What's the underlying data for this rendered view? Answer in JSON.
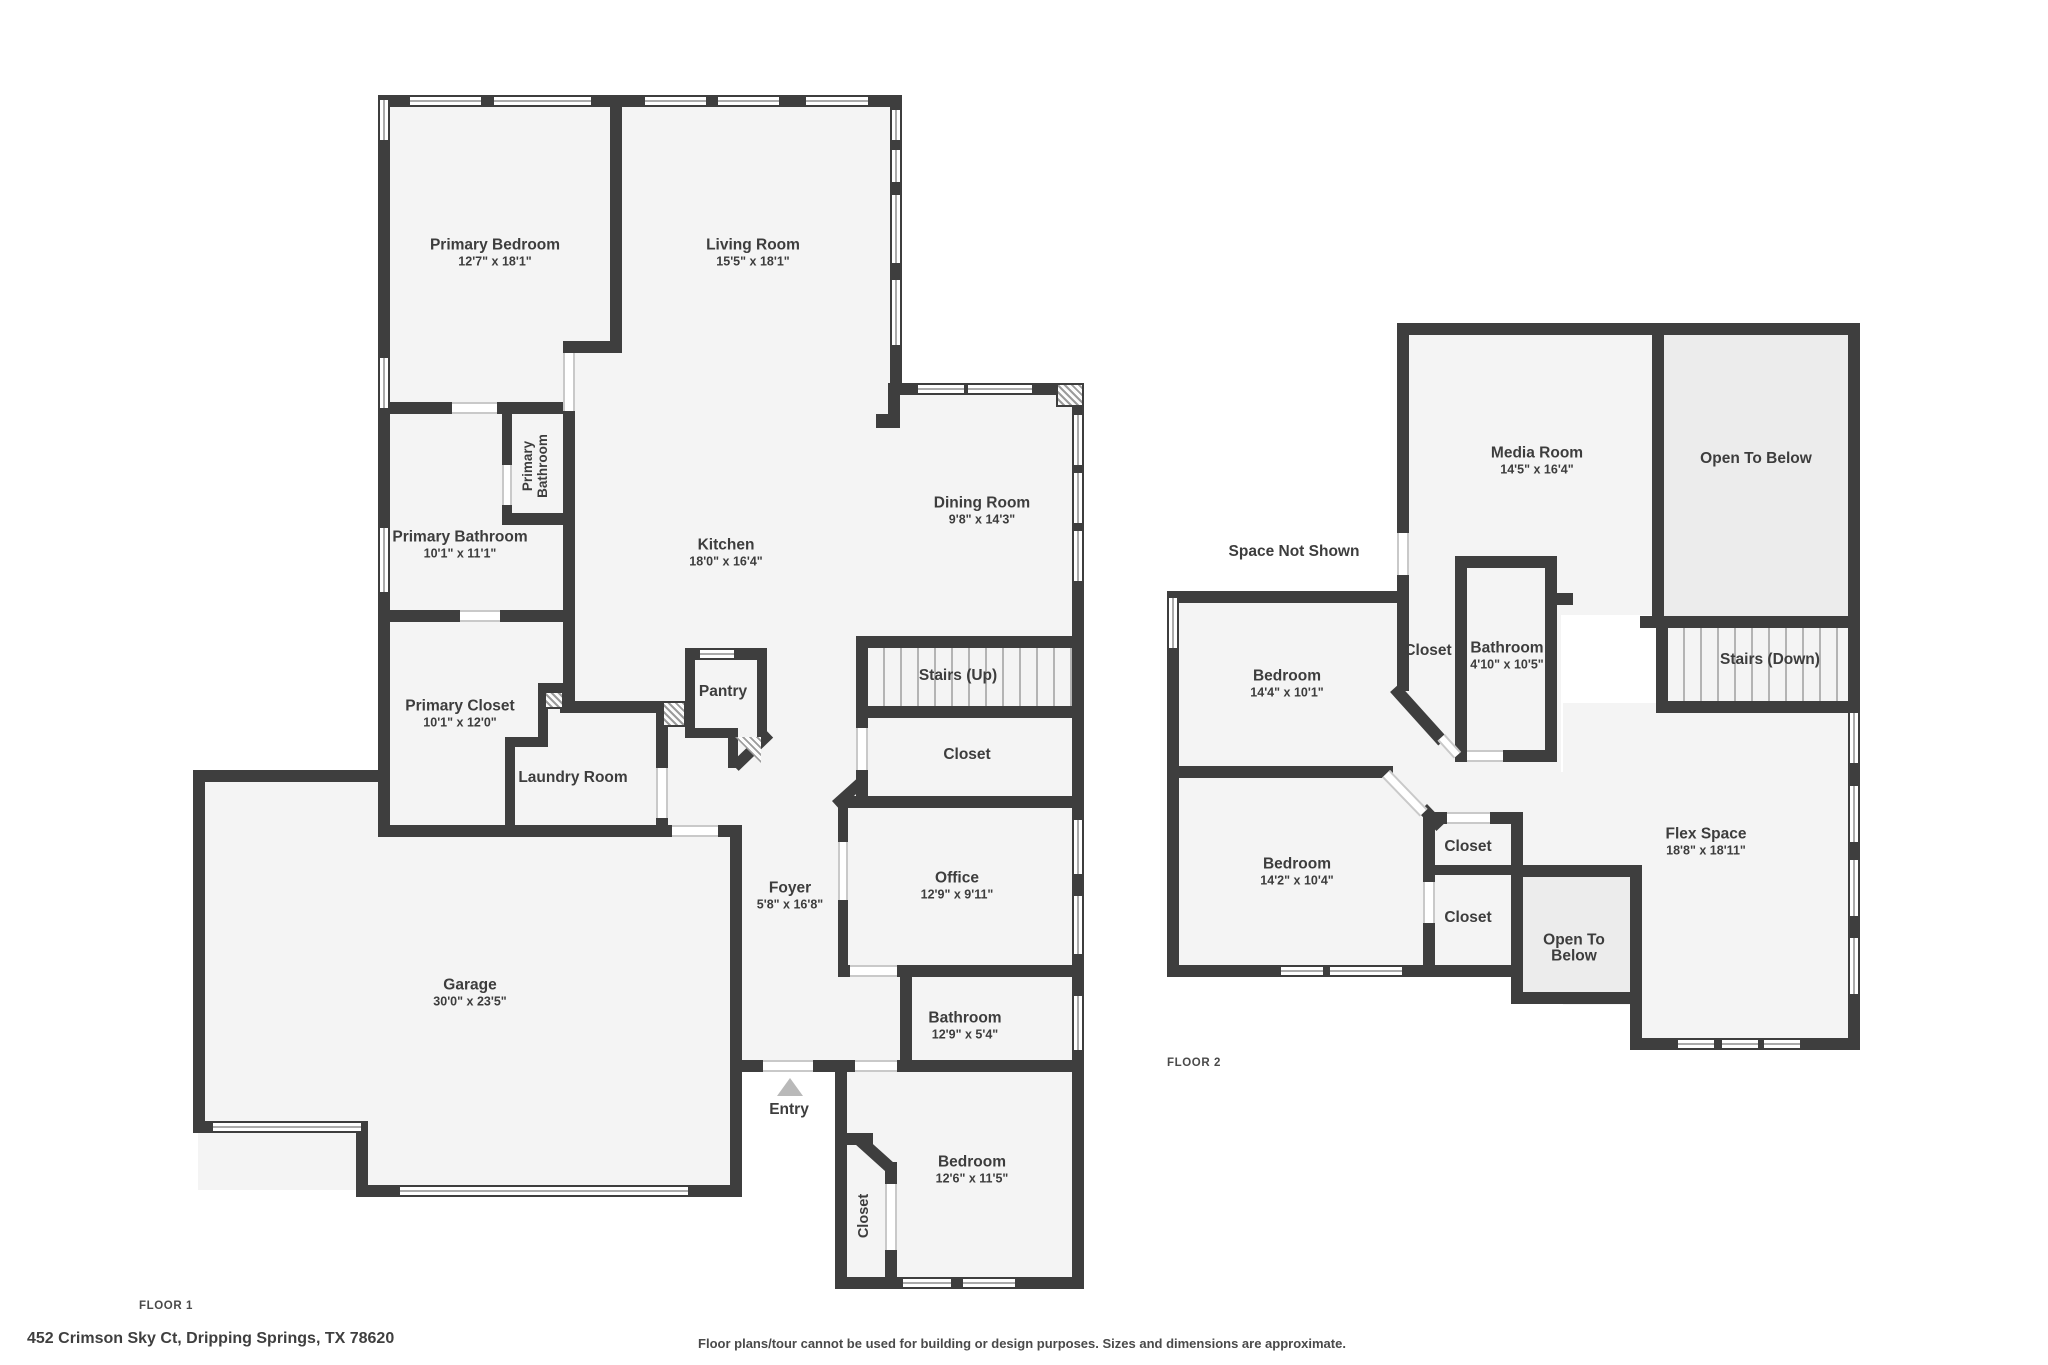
{
  "footer": {
    "address": "452 Crimson Sky Ct, Dripping Springs, TX 78620",
    "disclaimer": "Floor plans/tour cannot be used for building or design purposes. Sizes and dimensions are approximate."
  },
  "colors": {
    "wall": "#3e3e3e",
    "room_fill": "#f4f4f4",
    "open_to_below_fill": "#ececec",
    "label_text": "#3d3d3d",
    "entry_marker": "#b9b9b9"
  },
  "floor1": {
    "label": "FLOOR 1",
    "rooms": {
      "primary_bedroom": {
        "name": "Primary Bedroom",
        "dims": "12'7\" x 18'1\""
      },
      "living_room": {
        "name": "Living Room",
        "dims": "15'5\" x 18'1\""
      },
      "dining_room": {
        "name": "Dining Room",
        "dims": "9'8\" x 14'3\""
      },
      "kitchen": {
        "name": "Kitchen",
        "dims": "18'0\" x 16'4\""
      },
      "primary_bathroom_small": {
        "name": "Primary Bathroom"
      },
      "primary_bathroom": {
        "name": "Primary Bathroom",
        "dims": "10'1\" x 11'1\""
      },
      "primary_closet": {
        "name": "Primary Closet",
        "dims": "10'1\" x 12'0\""
      },
      "pantry": {
        "name": "Pantry"
      },
      "laundry_room": {
        "name": "Laundry Room"
      },
      "stairs_up": {
        "name": "Stairs (Up)"
      },
      "closet_hall": {
        "name": "Closet"
      },
      "office": {
        "name": "Office",
        "dims": "12'9\" x 9'11\""
      },
      "foyer": {
        "name": "Foyer",
        "dims": "5'8\" x 16'8\""
      },
      "bathroom": {
        "name": "Bathroom",
        "dims": "12'9\" x 5'4\""
      },
      "garage": {
        "name": "Garage",
        "dims": "30'0\" x 23'5\""
      },
      "entry": {
        "name": "Entry"
      },
      "bedroom": {
        "name": "Bedroom",
        "dims": "12'6\" x 11'5\""
      },
      "closet_bedroom": {
        "name": "Closet"
      }
    }
  },
  "floor2": {
    "label": "FLOOR 2",
    "rooms": {
      "media_room": {
        "name": "Media Room",
        "dims": "14'5\" x 16'4\""
      },
      "open_to_below": {
        "name": "Open To Below"
      },
      "space_not_shown": {
        "name": "Space Not Shown"
      },
      "bedroom_a": {
        "name": "Bedroom",
        "dims": "14'4\" x 10'1\""
      },
      "closet_hall": {
        "name": "Closet"
      },
      "bathroom": {
        "name": "Bathroom",
        "dims": "4'10\" x 10'5\""
      },
      "stairs_down": {
        "name": "Stairs (Down)"
      },
      "bedroom_b": {
        "name": "Bedroom",
        "dims": "14'2\" x 10'4\""
      },
      "closet_upper": {
        "name": "Closet"
      },
      "closet_lower": {
        "name": "Closet"
      },
      "open_to_below_small": {
        "name": "Open To Below"
      },
      "flex_space": {
        "name": "Flex Space",
        "dims": "18'8\" x 18'11\""
      }
    }
  }
}
